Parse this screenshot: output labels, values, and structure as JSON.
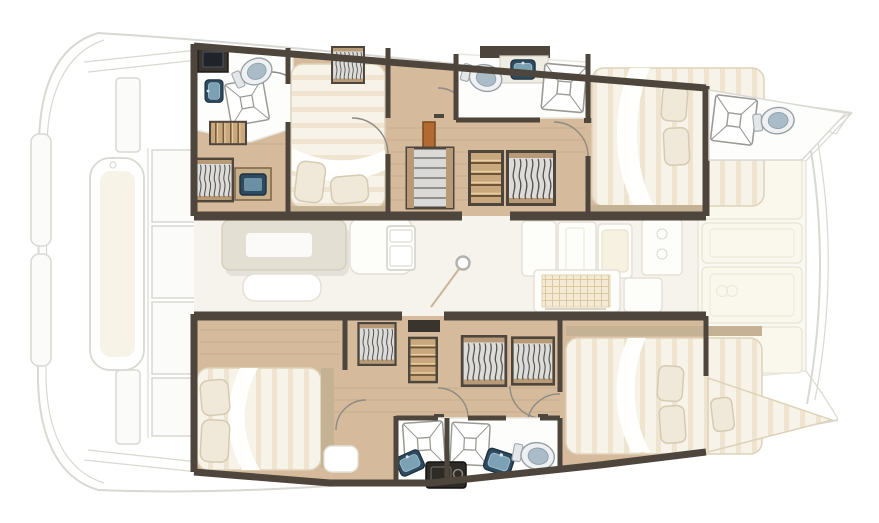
{
  "meta": {
    "title": "Catamaran yacht floor plan (top view, bow right)",
    "diagram_type": "floor-plan",
    "visible_text": "none"
  },
  "colors": {
    "wall": "#4e463c",
    "wall-dark": "#38322b",
    "wood": "#d5ba9b",
    "wood-2": "#c9ad8c",
    "wood-step": "#c9a87e",
    "floor-salon": "#f6f3ec",
    "white-floor": "#fdfdfb",
    "ghost-stroke": "#d9d8d2",
    "ghost-fill": "#fbfbf9",
    "mattress": "#f7f3e8",
    "mattress-stripe": "#ebdfc7",
    "pillow": "#f0e9d9",
    "pillow-edge": "#d6cab2",
    "platform-tan": "#c5b193",
    "locker": "#dcdcda",
    "hanger": "#57524c",
    "shower-line": "#9a9a94",
    "sink": "#2e4a5e",
    "sink-inner": "#7ca1b4",
    "toilet-rim": "#eef0f1",
    "toilet-seat": "#a9bcc7",
    "cabinet": "#3a342e",
    "module": "#2e2a26",
    "table": "#e4dfd3",
    "lounge-pad": "#faf8ec",
    "accent-door": "#b06a32",
    "arc": "#8f8b84"
  },
  "vessel": {
    "orientation": "bow-right",
    "hulls": {
      "port_top": {
        "rooms": [
          {
            "name": "aft-head",
            "fixtures": [
              "toilet",
              "shower",
              "sink",
              "dark-cabinet"
            ]
          },
          {
            "name": "aft-cabin",
            "fixtures": [
              "double-bed",
              "two-pillows",
              "vanity-desk",
              "hanging-locker",
              "steps"
            ]
          },
          {
            "name": "companionway",
            "fixtures": [
              "staircase",
              "hanging-locker",
              "shelf-unit",
              "wood-door"
            ]
          },
          {
            "name": "forward-head",
            "fixtures": [
              "toilet",
              "counter-sink",
              "shower"
            ]
          },
          {
            "name": "forward-cabin",
            "fixtures": [
              "double-bed",
              "two-pillows"
            ]
          },
          {
            "name": "bow-crew-head",
            "fixtures": [
              "shower",
              "toilet"
            ]
          }
        ]
      },
      "starboard_bottom": {
        "rooms": [
          {
            "name": "aft-cabin",
            "fixtures": [
              "double-bed",
              "two-pillows",
              "corner-seat"
            ]
          },
          {
            "name": "companionway",
            "fixtures": [
              "staircase",
              "hanging-locker",
              "hanging-locker"
            ]
          },
          {
            "name": "shared-head",
            "fixtures": [
              "shower",
              "shower",
              "sink",
              "sink",
              "toilet",
              "utility-module"
            ]
          },
          {
            "name": "forward-cabin",
            "fixtures": [
              "double-bed",
              "two-pillows"
            ]
          },
          {
            "name": "forepeak-berth",
            "fixtures": [
              "single-berth",
              "pillow"
            ]
          }
        ]
      }
    },
    "salon": {
      "fixtures": [
        "dining-table",
        "bench-seat",
        "sofa-seat",
        "refrigerator",
        "mast-post",
        "galley-counters",
        "galley-sink",
        "stove-grid",
        "galley-fridge"
      ]
    },
    "foredeck": {
      "fixtures": [
        "lounge-pad-1",
        "lounge-pad-2",
        "lounge-pad-3",
        "lounge-pad-4",
        "curved-crossbeam"
      ]
    },
    "stern": {
      "fixtures": [
        "cockpit-bench-cushion",
        "cockpit-floor-panels",
        "swim-steps",
        "roof-edge-lines"
      ]
    },
    "counts": {
      "double_beds": 4,
      "single_berths": 1,
      "toilets": 4,
      "showers": 5,
      "sinks": 4,
      "hanging_lockers": 5,
      "staircases": 3
    }
  }
}
